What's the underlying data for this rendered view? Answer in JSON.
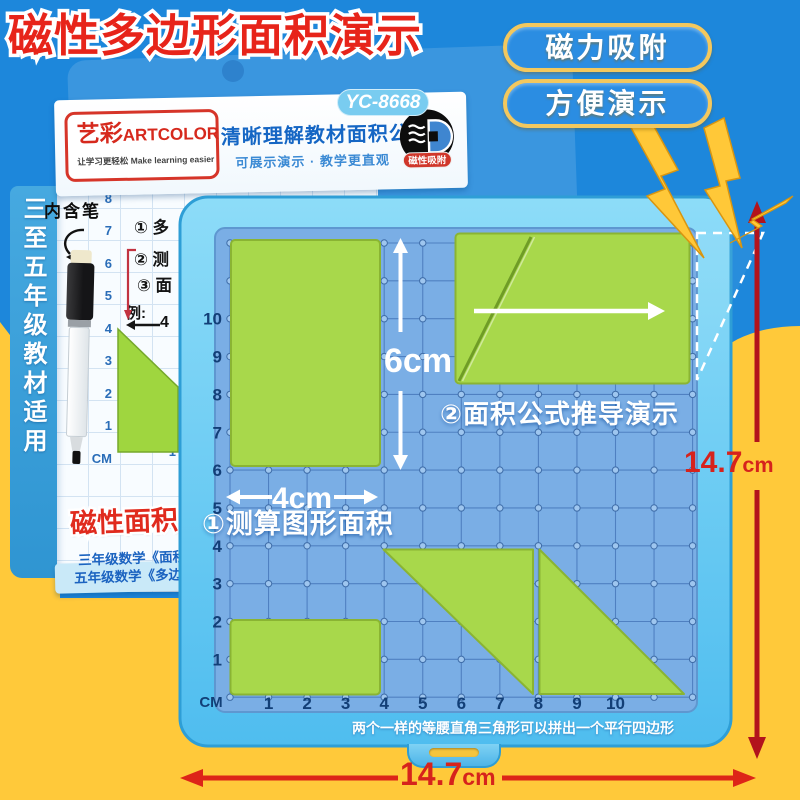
{
  "title": "磁性多边形面积演示",
  "badges": [
    {
      "label": "磁力吸附"
    },
    {
      "label": "方便演示"
    }
  ],
  "package": {
    "model": "YC-8668",
    "brand_cn": "艺彩",
    "brand_en": "ARTCOLOR",
    "brand_tagline": "让学习更轻松 Make learning easier",
    "headline": "清晰理解教材面积公式",
    "subheadline": "可展示演示 · 教学更直观",
    "magnet_badge": "磁性吸附",
    "pen_note": "内含笔",
    "side_text": "三至五年级教材适用",
    "steps": [
      "① 多",
      "② 测",
      "③ 面"
    ],
    "example_label": "例:",
    "example_value": "4",
    "grid_left_axis": [
      "9",
      "8",
      "7",
      "6",
      "5",
      "4",
      "3",
      "2",
      "1",
      "CM"
    ],
    "grid_bottom_axis": [
      "1"
    ],
    "bottom_title": "磁性面积",
    "bottom_lines": [
      "三年级数学《面积",
      "五年级数学《多边"
    ]
  },
  "board": {
    "left_axis": [
      "10",
      "9",
      "8",
      "7",
      "6",
      "5",
      "4",
      "3",
      "2",
      "1"
    ],
    "bottom_axis": [
      "1",
      "2",
      "3",
      "4",
      "5",
      "6",
      "7",
      "8",
      "9",
      "10"
    ],
    "unit_label": "CM",
    "height_label": "6cm",
    "width_label": "4cm",
    "step1_label": "①测算图形面积",
    "step2_label": "②面积公式推导演示",
    "caption": "两个一样的等腰直角三角形可以拼出一个平行四边形",
    "shapes": [
      {
        "name": "rectangle",
        "size": "4×6 cm",
        "position": "upper-left"
      },
      {
        "name": "rectangle-with-diagonal-cut",
        "position": "upper-right"
      },
      {
        "name": "rectangle",
        "size": "4×2 cm",
        "position": "bottom-left"
      },
      {
        "name": "right-triangle",
        "size": "4×4 cm",
        "position": "bottom-middle"
      },
      {
        "name": "right-triangle",
        "size": "4×4 cm",
        "position": "bottom-right"
      }
    ]
  },
  "measurements": {
    "width_value": "14.7",
    "height_value": "14.7",
    "unit": "cm"
  },
  "colors": {
    "bg_blue": "#1d87db",
    "bg_yellow": "#ffc93a",
    "title_red": "#e7241a",
    "accent_red": "#d6231c",
    "board_frame": "#5fc6f2",
    "board_surface": "#7aaee5",
    "grid_line": "#4b7cbe",
    "shape_green": "#a8d84b",
    "gold": "#f2c14e",
    "navy": "#123f77"
  }
}
